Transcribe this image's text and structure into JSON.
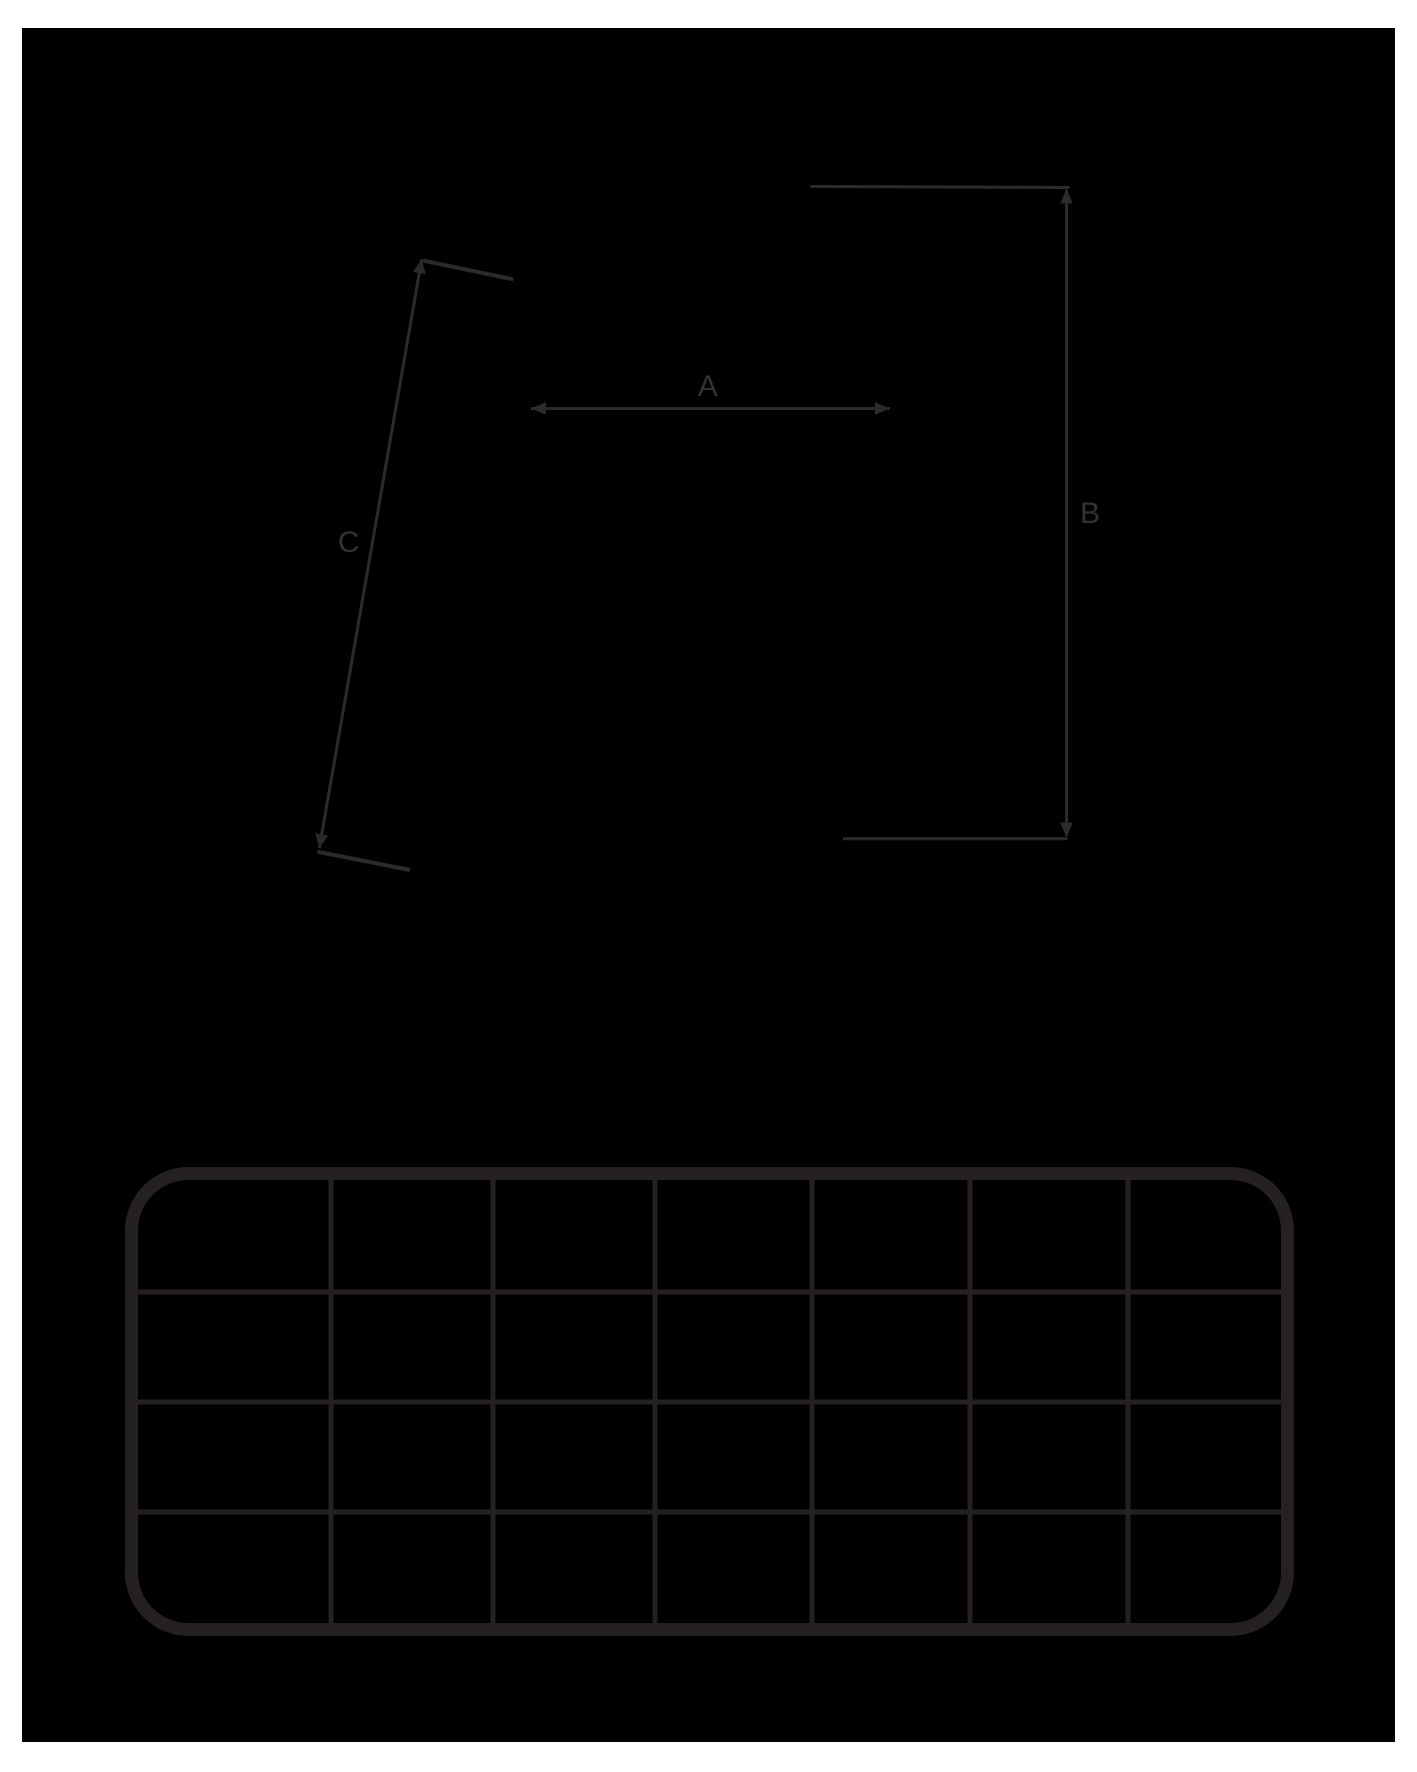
{
  "colors": {
    "page_background": "#ffffff",
    "canvas_background": "#000000",
    "dimension_line": "#2e2a2b",
    "dimension_label": "#363233",
    "grid_line": "#252021"
  },
  "dimensions": {
    "a": {
      "label": "A"
    },
    "b": {
      "label": "B"
    },
    "c": {
      "label": "C"
    }
  },
  "grid": {
    "rows": 4,
    "columns": 7
  }
}
